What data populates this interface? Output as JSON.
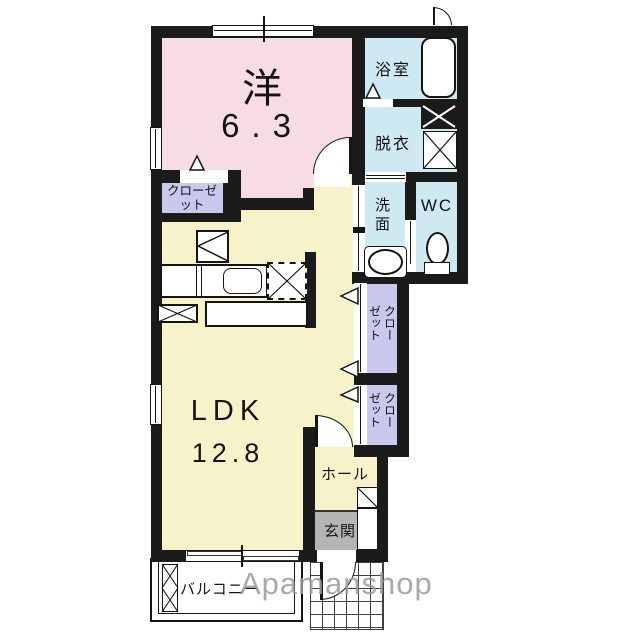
{
  "plan": {
    "watermark": "Apamanshop",
    "rooms": {
      "western": {
        "label": "洋",
        "area": "6.3"
      },
      "ldk": {
        "label": "LDK",
        "area": "12.8"
      },
      "bath": {
        "label": "浴室"
      },
      "dressing": {
        "label": "脱衣"
      },
      "washroom": {
        "label": "洗面"
      },
      "wc": {
        "label": "WC"
      },
      "closet_west": {
        "label": "クローゼット"
      },
      "closet_upper": {
        "label": "クローゼット"
      },
      "closet_lower": {
        "label": "クローゼット"
      },
      "hall": {
        "label": "ホール"
      },
      "entrance": {
        "label": "玄関"
      },
      "balcony": {
        "label": "バルコニー"
      }
    },
    "colors": {
      "wall": "#1b1b1b",
      "western_room": "#f7dbe7",
      "ldk_floor": "#f8f2cb",
      "sanitary_floor": "#cfe9f2",
      "closet_floor": "#c9c9ee",
      "entrance_floor": "#b5b5b5",
      "watermark_gray": "#9b9b9b"
    }
  }
}
